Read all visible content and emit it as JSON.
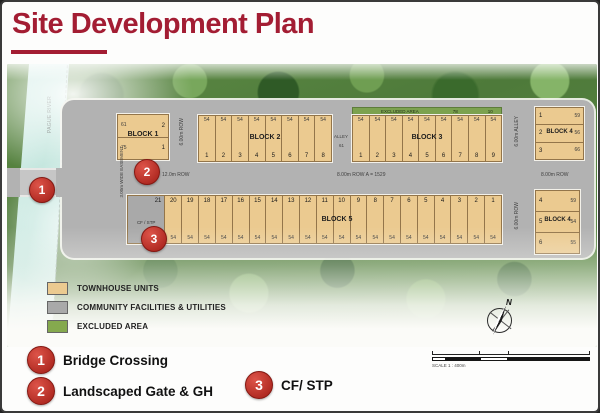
{
  "window": {
    "title": "Site Development Plan"
  },
  "plan": {
    "labels": {
      "river": "PAGUE RIVER",
      "easement": "3.00m WIDE EASEMENT",
      "row_12": "12.0m ROW",
      "row_main": "8.00m ROW    A = 1529",
      "row_6_left": "6.00m ROW",
      "alley_top": "ALLEY",
      "alley_top_num": "61",
      "alley_6_right": "6.00m ALLEY",
      "row_8_right": "8.00m ROW",
      "row_6_right": "6.00m ROW",
      "excluded": "EXCLUDED AREA",
      "excluded_n1": "78",
      "excluded_n2": "10",
      "north": "N"
    },
    "blocks": {
      "block1": {
        "name": "BLOCK 1",
        "units": [
          {
            "no": "2",
            "area": "61"
          },
          {
            "no": "1",
            "area": "75"
          }
        ]
      },
      "block2": {
        "name": "BLOCK 2",
        "units": [
          {
            "no": "1",
            "area": "54"
          },
          {
            "no": "2",
            "area": "54"
          },
          {
            "no": "3",
            "area": "54"
          },
          {
            "no": "4",
            "area": "54"
          },
          {
            "no": "5",
            "area": "54"
          },
          {
            "no": "6",
            "area": "54"
          },
          {
            "no": "7",
            "area": "54"
          },
          {
            "no": "8",
            "area": "54"
          }
        ]
      },
      "block3": {
        "name": "BLOCK 3",
        "units": [
          {
            "no": "1",
            "area": "54"
          },
          {
            "no": "2",
            "area": "54"
          },
          {
            "no": "3",
            "area": "54"
          },
          {
            "no": "4",
            "area": "54"
          },
          {
            "no": "5",
            "area": "54"
          },
          {
            "no": "6",
            "area": "54"
          },
          {
            "no": "7",
            "area": "54"
          },
          {
            "no": "8",
            "area": "54"
          },
          {
            "no": "9",
            "area": "54"
          }
        ]
      },
      "block4_upper": {
        "name": "BLOCK 4",
        "units": [
          {
            "no": "1",
            "area": "59"
          },
          {
            "no": "2",
            "area": "56"
          },
          {
            "no": "3",
            "area": "66"
          }
        ]
      },
      "block4_lower": {
        "name": "BLOCK 4",
        "units": [
          {
            "no": "4",
            "area": "59"
          },
          {
            "no": "5",
            "area": "54"
          },
          {
            "no": "6",
            "area": "55"
          }
        ]
      },
      "block5": {
        "name": "BLOCK 5",
        "units": [
          {
            "no": "21",
            "label": "CF / STP",
            "type": "facility"
          },
          {
            "no": "20",
            "area": "54"
          },
          {
            "no": "19",
            "area": "54"
          },
          {
            "no": "18",
            "area": "54"
          },
          {
            "no": "17",
            "area": "54"
          },
          {
            "no": "16",
            "area": "54"
          },
          {
            "no": "15",
            "area": "54"
          },
          {
            "no": "14",
            "area": "54"
          },
          {
            "no": "13",
            "area": "54"
          },
          {
            "no": "12",
            "area": "54"
          },
          {
            "no": "11",
            "area": "54"
          },
          {
            "no": "10",
            "area": "54"
          },
          {
            "no": "9",
            "area": "54"
          },
          {
            "no": "8",
            "area": "54"
          },
          {
            "no": "7",
            "area": "54"
          },
          {
            "no": "6",
            "area": "54"
          },
          {
            "no": "5",
            "area": "54"
          },
          {
            "no": "4",
            "area": "54"
          },
          {
            "no": "3",
            "area": "54"
          },
          {
            "no": "2",
            "area": "54"
          },
          {
            "no": "1",
            "area": "54"
          }
        ]
      }
    }
  },
  "legend": {
    "items": [
      {
        "label": "TOWNHOUSE UNITS",
        "color": "#ebca90"
      },
      {
        "label": "COMMUNITY FACILITIES & UTILITIES",
        "color": "#a9a9a9"
      },
      {
        "label": "EXCLUDED AREA",
        "color": "#85a94e"
      }
    ]
  },
  "scale": {
    "label": "SCALE 1 : 400m"
  },
  "callouts": [
    {
      "num": "1",
      "label": "Bridge Crossing"
    },
    {
      "num": "2",
      "label": "Landscaped Gate & GH"
    },
    {
      "num": "3",
      "label": "CF/ STP"
    }
  ],
  "colors": {
    "accent_red": "#a31d33",
    "marker_red": "#b02a22",
    "lot_tan": "#ebca90",
    "road_gray": "#b2b2b2",
    "facility_gray": "#a9a9a9",
    "excluded_green": "#7ca24f",
    "river_teal": "#bfe4db"
  }
}
